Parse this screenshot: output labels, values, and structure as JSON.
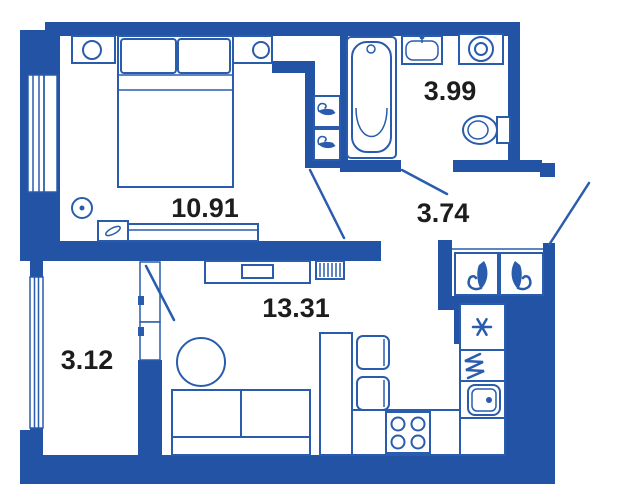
{
  "plan": {
    "type": "apartment-floor-plan",
    "colors": {
      "wall": "#2253a4",
      "line": "#2a5cae",
      "text": "#1d1d1d"
    },
    "rooms": [
      {
        "id": "bedroom",
        "area_label": "10.91"
      },
      {
        "id": "bathroom",
        "area_label": "3.99"
      },
      {
        "id": "hallway",
        "area_label": "3.74"
      },
      {
        "id": "living-kitchen",
        "area_label": "13.31"
      },
      {
        "id": "balcony",
        "area_label": "3.12"
      }
    ],
    "icons": {
      "fridge": "snowflake-asterisk",
      "wardrobe_cell": "clothes-hanger",
      "stove": "four-burner-hob",
      "heater": "coil",
      "radiator": "hatched-box"
    }
  }
}
